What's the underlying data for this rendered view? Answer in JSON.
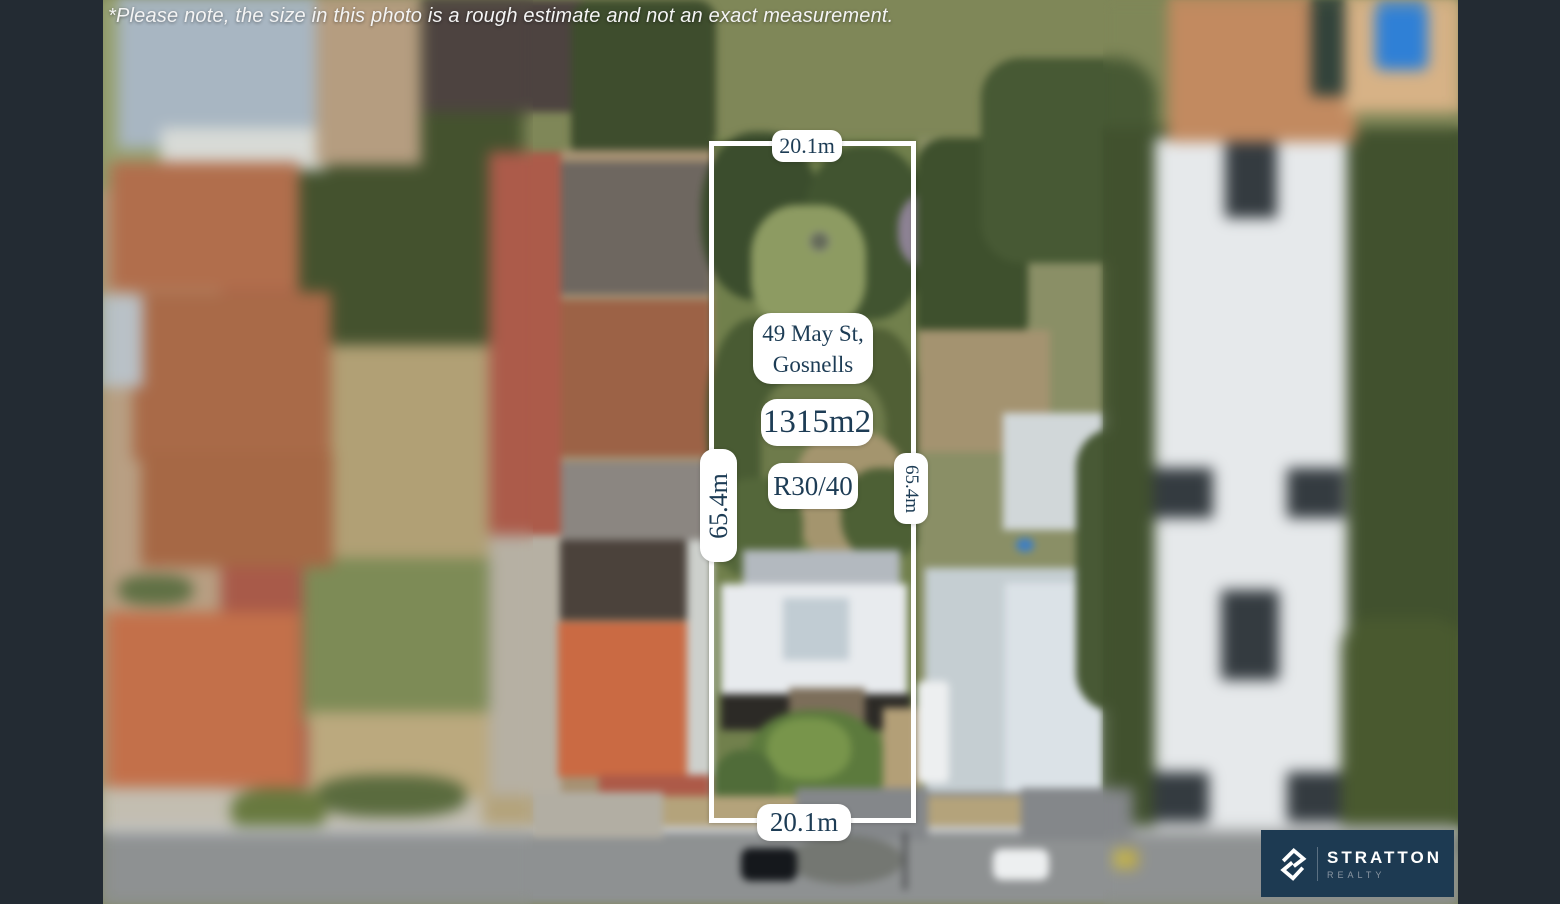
{
  "disclaimer": "*Please note, the size in this photo is a rough estimate and not an exact measurement.",
  "parcel": {
    "address_line1": "49 May St,",
    "address_line2": "Gosnells",
    "area": "1315m2",
    "zoning": "R30/40",
    "frontage_top": "20.1m",
    "frontage_bottom": "20.1m",
    "depth_left": "65.4m",
    "depth_right": "65.4m"
  },
  "logo": {
    "name": "STRATTON",
    "tagline": "REALTY"
  },
  "colors": {
    "annotation_text": "#1d3c55",
    "annotation_bg": "#ffffff",
    "boundary": "#ffffff",
    "logo_bg": "#1d3a52",
    "frame_bar": "#232b33"
  }
}
